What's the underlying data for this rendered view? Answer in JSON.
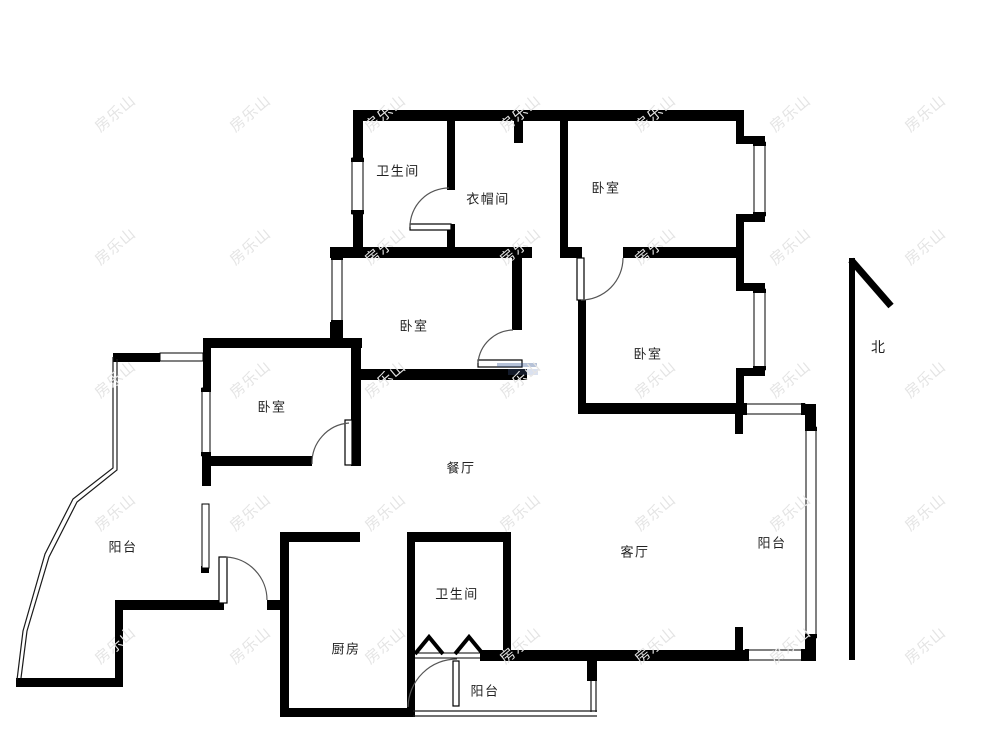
{
  "watermark": {
    "text": "房乐山",
    "color": "#e4e4e4"
  },
  "compass": {
    "label": "北"
  },
  "rooms": {
    "bathroom_top": {
      "label": "卫生间"
    },
    "cloakroom": {
      "label": "衣帽间"
    },
    "bedroom_top_right": {
      "label": "卧室"
    },
    "bedroom_middle": {
      "label": "卧室"
    },
    "bedroom_right": {
      "label": "卧室"
    },
    "bedroom_left": {
      "label": "卧室"
    },
    "dining_room": {
      "label": "餐厅"
    },
    "living_room": {
      "label": "客厅"
    },
    "balcony_left": {
      "label": "阳台"
    },
    "balcony_right": {
      "label": "阳台"
    },
    "balcony_bottom": {
      "label": "阳台"
    },
    "kitchen": {
      "label": "厨房"
    },
    "bathroom_bottom": {
      "label": "卫生间"
    }
  }
}
